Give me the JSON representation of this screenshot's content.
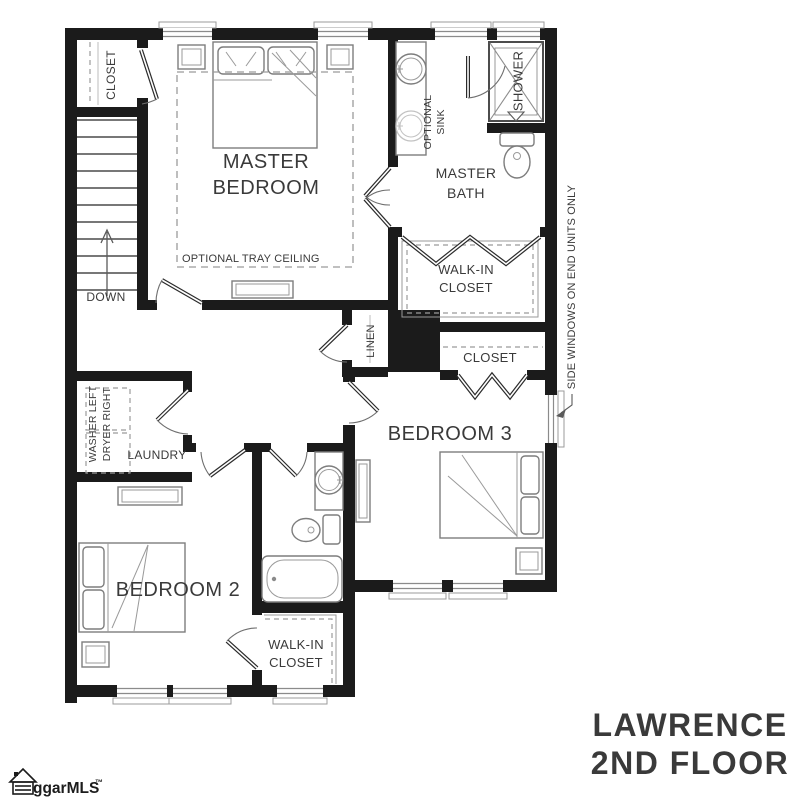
{
  "colors": {
    "accent_orange": "#E08138",
    "wall_black": "#1b1b1b",
    "furniture_gray": "#7d7d7d",
    "label_gray": "#3a3a3a"
  },
  "title": {
    "line1": "LAWRENCE",
    "line2": "2ND FLOOR"
  },
  "logo": {
    "name": "ggarMLS",
    "trademark": "™"
  },
  "rooms": {
    "master_bedroom": {
      "line1": "MASTER",
      "line2": "BEDROOM"
    },
    "master_bath": {
      "line1": "MASTER",
      "line2": "BATH"
    },
    "master_closet": {
      "line1": "WALK-IN",
      "line2": "CLOSET"
    },
    "bedroom2": "BEDROOM 2",
    "bedroom3": "BEDROOM 3",
    "bedroom2_closet": {
      "line1": "WALK-IN",
      "line2": "CLOSET"
    },
    "laundry": "LAUNDRY",
    "linen": "LINEN",
    "hall_closet": "CLOSET",
    "bedroom3_closet": "CLOSET",
    "shower": "SHOWER"
  },
  "annotations": {
    "optional_sink_line1": "OPTIONAL",
    "optional_sink_line2": "SINK",
    "optional_tray_ceiling": "OPTIONAL TRAY CEILING",
    "down": "DOWN",
    "washer": "WASHER LEFT",
    "dryer": "DRYER RIGHT",
    "side_windows": "SIDE WINDOWS ON END UNITS ONLY"
  }
}
